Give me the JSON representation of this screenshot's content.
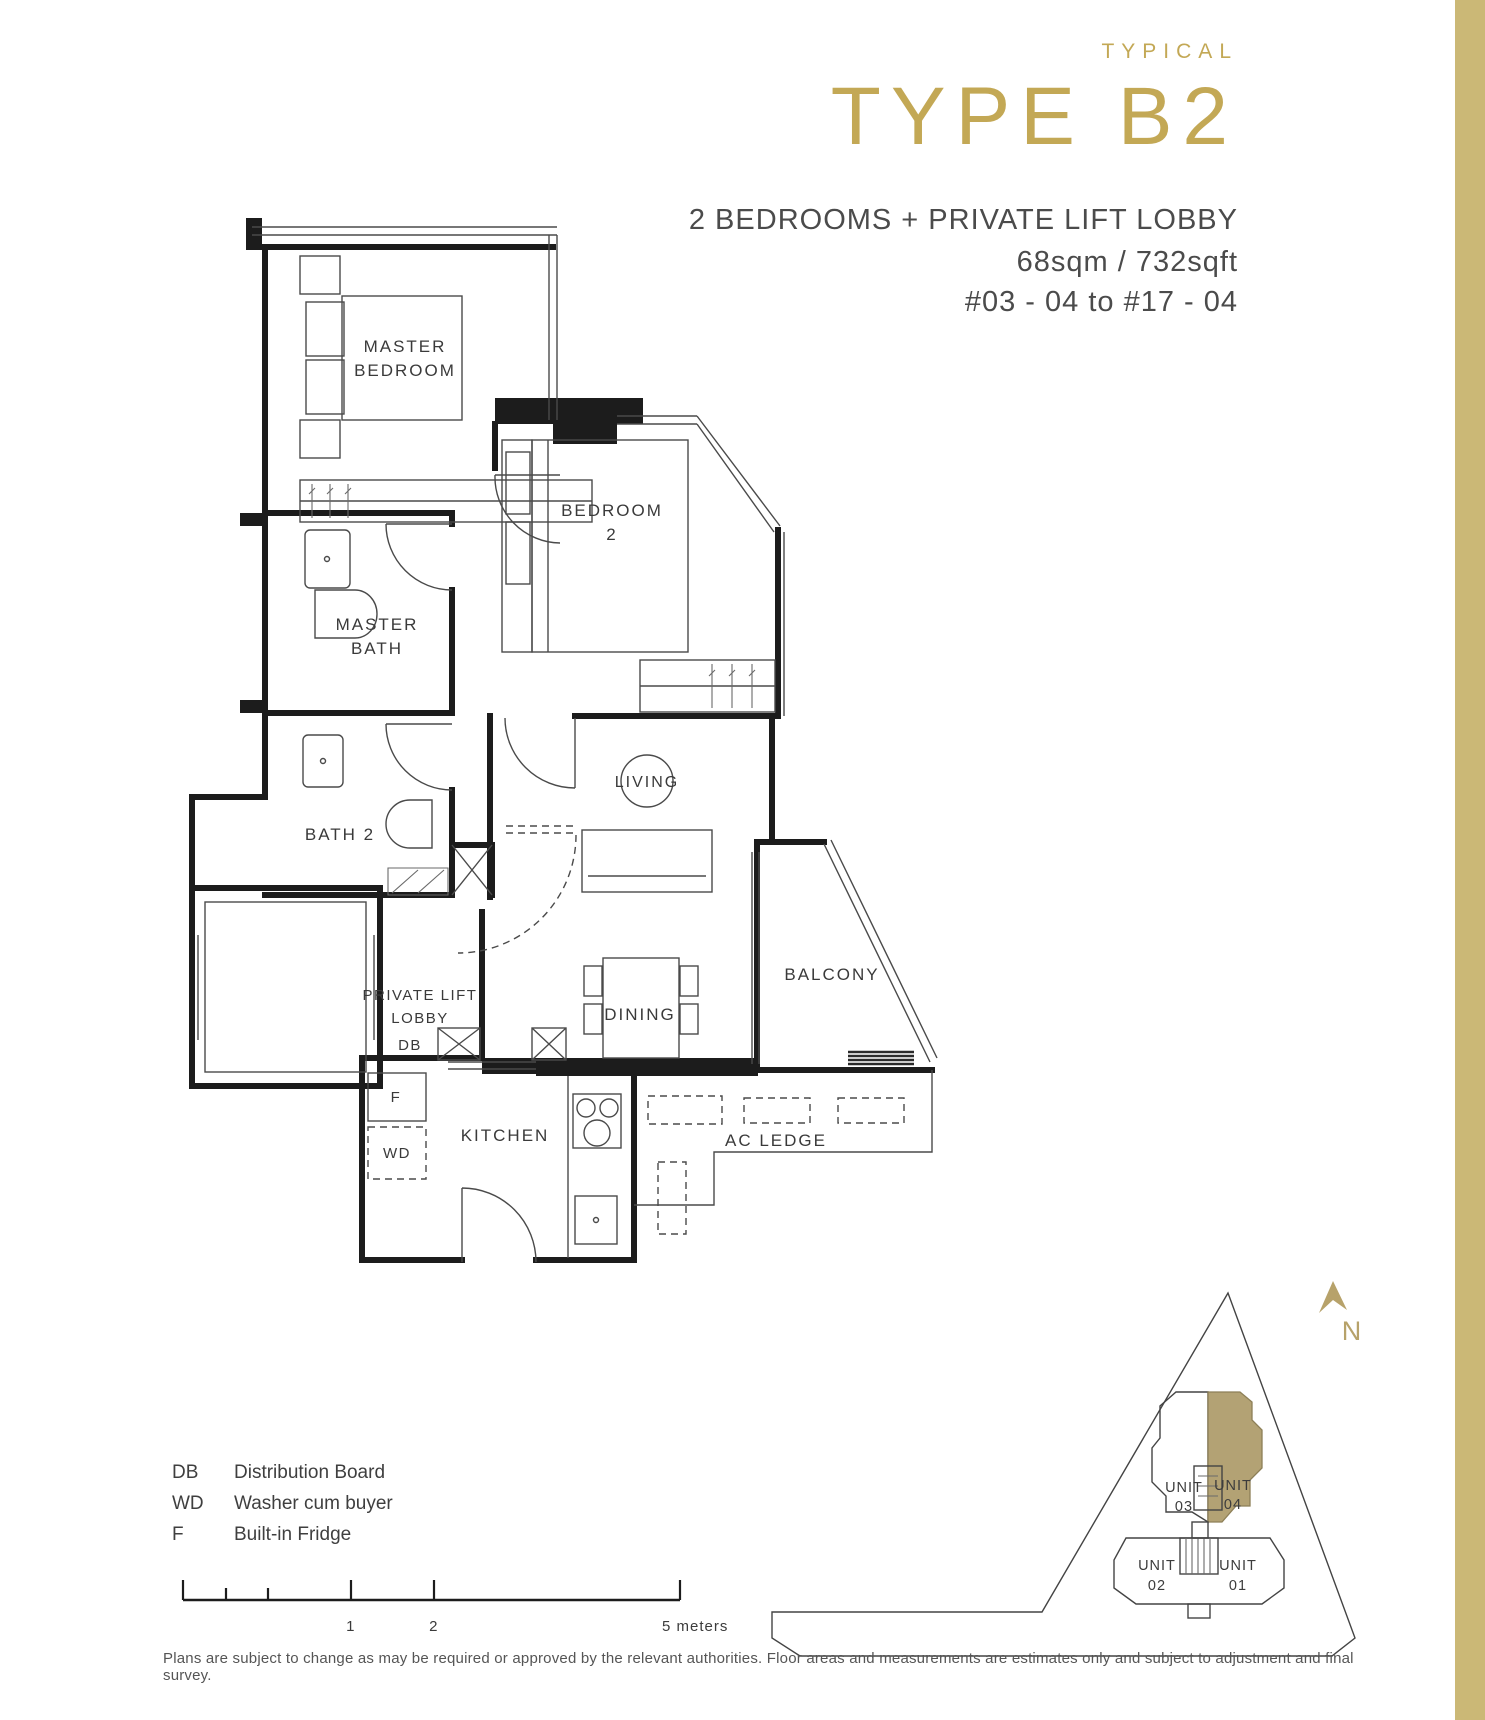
{
  "colors": {
    "accent_gold": "#C3A855",
    "sidebar_gold": "#CBB876",
    "unit_highlight": "#B3A274",
    "north_gold": "#B7A26A"
  },
  "header": {
    "eyebrow": "TYPICAL",
    "title": "TYPE B2",
    "subtitle": "2 BEDROOMS + PRIVATE LIFT LOBBY",
    "area": "68sqm / 732sqft",
    "levels": "#03 - 04 to #17 - 04"
  },
  "plan": {
    "master_bedroom": [
      "MASTER",
      "BEDROOM"
    ],
    "bedroom2": [
      "BEDROOM",
      "2"
    ],
    "master_bath": [
      "MASTER",
      "BATH"
    ],
    "bath2": "BATH 2",
    "living": "LIVING",
    "dining": "DINING",
    "balcony": "BALCONY",
    "kitchen": "KITCHEN",
    "lobby": [
      "PRIVATE LIFT",
      "LOBBY"
    ],
    "db": "DB",
    "f": "F",
    "wd": "WD",
    "ac_ledge": "AC LEDGE"
  },
  "legend": {
    "items": [
      {
        "abbr": "DB",
        "label": "Distribution Board"
      },
      {
        "abbr": "WD",
        "label": "Washer cum buyer"
      },
      {
        "abbr": "F",
        "label": "Built-in Fridge"
      }
    ]
  },
  "scale": {
    "m1": "1",
    "m2": "2",
    "m5": "5 meters"
  },
  "site": {
    "unit03": [
      "UNIT",
      "03"
    ],
    "unit04": [
      "UNIT",
      "04"
    ],
    "unit02": [
      "UNIT",
      "02"
    ],
    "unit01": [
      "UNIT",
      "01"
    ],
    "north": "N"
  },
  "footer": {
    "disclaimer": "Plans are subject to change as may be required or approved by the relevant authorities.  Floor areas and measurements are estimates only and subject to adjustment and final survey."
  }
}
